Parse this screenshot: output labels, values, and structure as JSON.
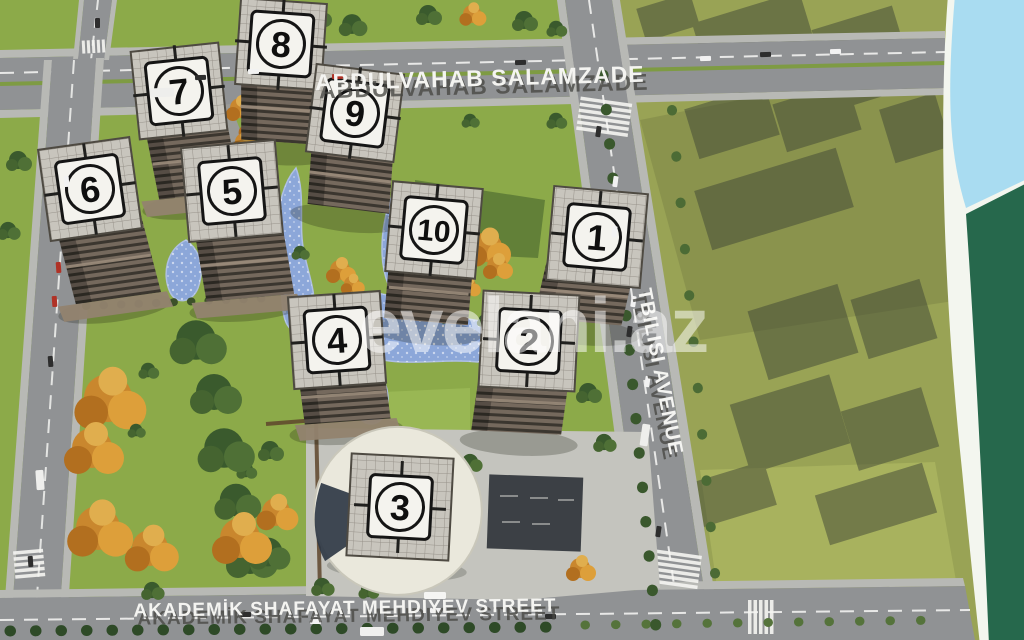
{
  "streets": {
    "top": {
      "label": "ABDULVAHAB SALAMZADE"
    },
    "bottom": {
      "label": "AKADEMİK SHAFAYAT MEHDIYEV STREET"
    },
    "right": {
      "label": "TBILISI AVENUE"
    }
  },
  "watermark": {
    "label": "evelani.az"
  },
  "buildings": [
    {
      "label": "1"
    },
    {
      "label": "2"
    },
    {
      "label": "3"
    },
    {
      "label": "4"
    },
    {
      "label": "5"
    },
    {
      "label": "6"
    },
    {
      "label": "7"
    },
    {
      "label": "8"
    },
    {
      "label": "9"
    },
    {
      "label": "10"
    }
  ],
  "colors": {
    "grass": "#8caa49",
    "road": "#909294",
    "water": "#8ca7d9",
    "autumn": "#cc8a2f",
    "band_sky": "#a9dcf1",
    "band_green": "#26684c"
  }
}
